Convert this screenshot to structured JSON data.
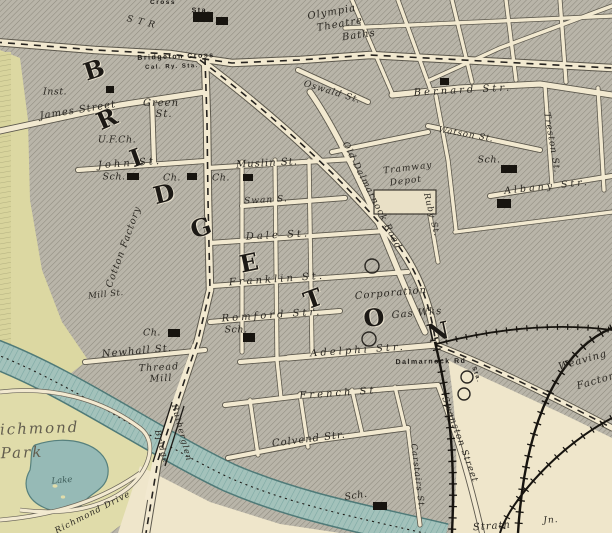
{
  "map": {
    "type": "vintage-street-map",
    "district_letters": "BRIDGETON",
    "colors": {
      "paper": "#efe6cb",
      "block_hatch": "#b9b5a9",
      "hatch_line": "#8f8b7f",
      "road": "#f2e9d0",
      "park": "#dfdba8",
      "park_strip": "#dcd8a2",
      "river": "#a3c2bb",
      "river_stripe": "#7ea9a4",
      "lake": "#96bab6",
      "ink": "#1c1915"
    },
    "labels": [
      {
        "text": "Cross",
        "x": 163,
        "y": 3,
        "r": 0,
        "cls": "caps",
        "fs": 6.5
      },
      {
        "text": "Sta.",
        "x": 201,
        "y": 11,
        "r": 0,
        "cls": "caps"
      },
      {
        "text": "Olympia",
        "x": 332,
        "y": 13,
        "r": -10,
        "cls": "street"
      },
      {
        "text": "Theatre",
        "x": 340,
        "y": 25,
        "r": -10,
        "cls": "street"
      },
      {
        "text": "Baths",
        "x": 359,
        "y": 36,
        "r": -8,
        "cls": "street"
      },
      {
        "text": "S T R",
        "x": 141,
        "y": 23,
        "r": 14,
        "cls": "street",
        "fs": 9
      },
      {
        "text": "Bridgeton Cross",
        "x": 176,
        "y": 57,
        "r": -2,
        "cls": "caps"
      },
      {
        "text": "Cal. Ry. Sta.",
        "x": 172,
        "y": 67,
        "r": -2,
        "cls": "caps",
        "fs": 6
      },
      {
        "text": "Inst.",
        "x": 55,
        "y": 92,
        "r": 0,
        "cls": "poi"
      },
      {
        "text": "James Street",
        "x": 78,
        "y": 111,
        "r": -9,
        "cls": "street"
      },
      {
        "text": "Green",
        "x": 161,
        "y": 104,
        "r": 0,
        "cls": "street"
      },
      {
        "text": "St.",
        "x": 164,
        "y": 115,
        "r": 0,
        "cls": "street"
      },
      {
        "text": "U.F.Ch.",
        "x": 117,
        "y": 140,
        "r": 0,
        "cls": "poi"
      },
      {
        "text": "B",
        "x": 94,
        "y": 70,
        "r": -18,
        "cls": "big"
      },
      {
        "text": "R",
        "x": 107,
        "y": 119,
        "r": -24,
        "cls": "big"
      },
      {
        "text": "I",
        "x": 136,
        "y": 158,
        "r": -20,
        "cls": "big"
      },
      {
        "text": "D",
        "x": 164,
        "y": 194,
        "r": -14,
        "cls": "big"
      },
      {
        "text": "G",
        "x": 201,
        "y": 228,
        "r": -18,
        "cls": "big"
      },
      {
        "text": "E",
        "x": 249,
        "y": 263,
        "r": -12,
        "cls": "big"
      },
      {
        "text": "T",
        "x": 313,
        "y": 299,
        "r": -20,
        "cls": "big"
      },
      {
        "text": "O",
        "x": 374,
        "y": 318,
        "r": -8,
        "cls": "big"
      },
      {
        "text": "N",
        "x": 438,
        "y": 332,
        "r": -12,
        "cls": "big"
      },
      {
        "text": "John St.",
        "x": 130,
        "y": 164,
        "r": -4,
        "cls": "street sp"
      },
      {
        "text": "Sch.",
        "x": 114,
        "y": 177,
        "r": 0,
        "cls": "poi"
      },
      {
        "text": "Ch.",
        "x": 172,
        "y": 178,
        "r": 0,
        "cls": "poi"
      },
      {
        "text": "Muslin St.",
        "x": 267,
        "y": 164,
        "r": -3,
        "cls": "street"
      },
      {
        "text": "Ch.",
        "x": 221,
        "y": 178,
        "r": 0,
        "cls": "poi"
      },
      {
        "text": "Swan S.",
        "x": 266,
        "y": 201,
        "r": -3,
        "cls": "street",
        "fs": 9
      },
      {
        "text": "Dale St.",
        "x": 278,
        "y": 236,
        "r": -3,
        "cls": "street sp"
      },
      {
        "text": "Cotton Factory",
        "x": 124,
        "y": 247,
        "r": -70,
        "cls": "street",
        "fs": 9.5
      },
      {
        "text": "Mill St.",
        "x": 106,
        "y": 295,
        "r": -6,
        "cls": "poi",
        "fs": 8.5
      },
      {
        "text": "Franklin St.",
        "x": 277,
        "y": 280,
        "r": -4,
        "cls": "street sp"
      },
      {
        "text": "Romford Str.",
        "x": 272,
        "y": 316,
        "r": -4,
        "cls": "street sp"
      },
      {
        "text": "Sch.",
        "x": 236,
        "y": 330,
        "r": 0,
        "cls": "poi"
      },
      {
        "text": "Ch.",
        "x": 152,
        "y": 333,
        "r": 0,
        "cls": "poi"
      },
      {
        "text": "Newhall St.",
        "x": 137,
        "y": 352,
        "r": -5,
        "cls": "street"
      },
      {
        "text": "Thread",
        "x": 159,
        "y": 368,
        "r": -3,
        "cls": "street",
        "fs": 9.5
      },
      {
        "text": "Mill",
        "x": 161,
        "y": 379,
        "r": -3,
        "cls": "street",
        "fs": 9.5
      },
      {
        "text": "Corporation",
        "x": 391,
        "y": 294,
        "r": -5,
        "cls": "street"
      },
      {
        "text": "Gas Wks",
        "x": 417,
        "y": 314,
        "r": -5,
        "cls": "street"
      },
      {
        "text": "Adelphi Str.",
        "x": 358,
        "y": 351,
        "r": -4,
        "cls": "street sp"
      },
      {
        "text": "Old Dalmarnock Road",
        "x": 371,
        "y": 196,
        "r": 63,
        "cls": "street",
        "fs": 9
      },
      {
        "text": "Oswald St.",
        "x": 332,
        "y": 93,
        "r": 17,
        "cls": "street",
        "fs": 9
      },
      {
        "text": "Ruby St.",
        "x": 431,
        "y": 215,
        "r": 76,
        "cls": "street",
        "fs": 8.5
      },
      {
        "text": "Tramway",
        "x": 408,
        "y": 169,
        "r": -7,
        "cls": "street",
        "fs": 9
      },
      {
        "text": "Depot",
        "x": 406,
        "y": 182,
        "r": -7,
        "cls": "street",
        "fs": 9
      },
      {
        "text": "Sch.",
        "x": 489,
        "y": 160,
        "r": 0,
        "cls": "poi"
      },
      {
        "text": "Bernard Str.",
        "x": 463,
        "y": 91,
        "r": -3,
        "cls": "street sp"
      },
      {
        "text": "Watson St.",
        "x": 466,
        "y": 135,
        "r": 10,
        "cls": "street",
        "fs": 8.5
      },
      {
        "text": "Treston St.",
        "x": 551,
        "y": 143,
        "r": 80,
        "cls": "street",
        "fs": 9
      },
      {
        "text": "Albany Str.",
        "x": 547,
        "y": 187,
        "r": -6,
        "cls": "street sp",
        "fs": 9.5
      },
      {
        "text": "Dalmarnock Rd",
        "x": 431,
        "y": 362,
        "r": -1,
        "cls": "caps"
      },
      {
        "text": "Sta.",
        "x": 476,
        "y": 375,
        "r": 70,
        "cls": "caps",
        "fs": 6
      },
      {
        "text": "French St",
        "x": 338,
        "y": 394,
        "r": -4,
        "cls": "street sp"
      },
      {
        "text": "Colvend Str.",
        "x": 309,
        "y": 440,
        "r": -7,
        "cls": "street"
      },
      {
        "text": "Sch.",
        "x": 356,
        "y": 496,
        "r": -8,
        "cls": "poi"
      },
      {
        "text": "Swanston Street",
        "x": 459,
        "y": 440,
        "r": 70,
        "cls": "street",
        "fs": 9
      },
      {
        "text": "Carstairs St.",
        "x": 417,
        "y": 477,
        "r": 83,
        "cls": "street",
        "fs": 8.5
      },
      {
        "text": "Weaving",
        "x": 583,
        "y": 361,
        "r": -16,
        "cls": "street"
      },
      {
        "text": "Factory",
        "x": 599,
        "y": 381,
        "r": -16,
        "cls": "street"
      },
      {
        "text": "Richmond",
        "x": 33,
        "y": 429,
        "r": -2,
        "cls": "park"
      },
      {
        "text": "Park",
        "x": 22,
        "y": 453,
        "r": -2,
        "cls": "park"
      },
      {
        "text": "Lake",
        "x": 62,
        "y": 481,
        "r": -5,
        "cls": "water"
      },
      {
        "text": "Rutherglen",
        "x": 181,
        "y": 433,
        "r": 75,
        "cls": "street",
        "fs": 8.5
      },
      {
        "text": "Bridge",
        "x": 161,
        "y": 447,
        "r": 75,
        "cls": "street",
        "fs": 8.5
      },
      {
        "text": "Richmond Drive",
        "x": 93,
        "y": 513,
        "r": -27,
        "cls": "street",
        "fs": 8.5
      },
      {
        "text": "Strath",
        "x": 492,
        "y": 527,
        "r": -4,
        "cls": "street"
      },
      {
        "text": "Jn.",
        "x": 551,
        "y": 521,
        "r": -4,
        "cls": "street",
        "fs": 9
      }
    ]
  }
}
